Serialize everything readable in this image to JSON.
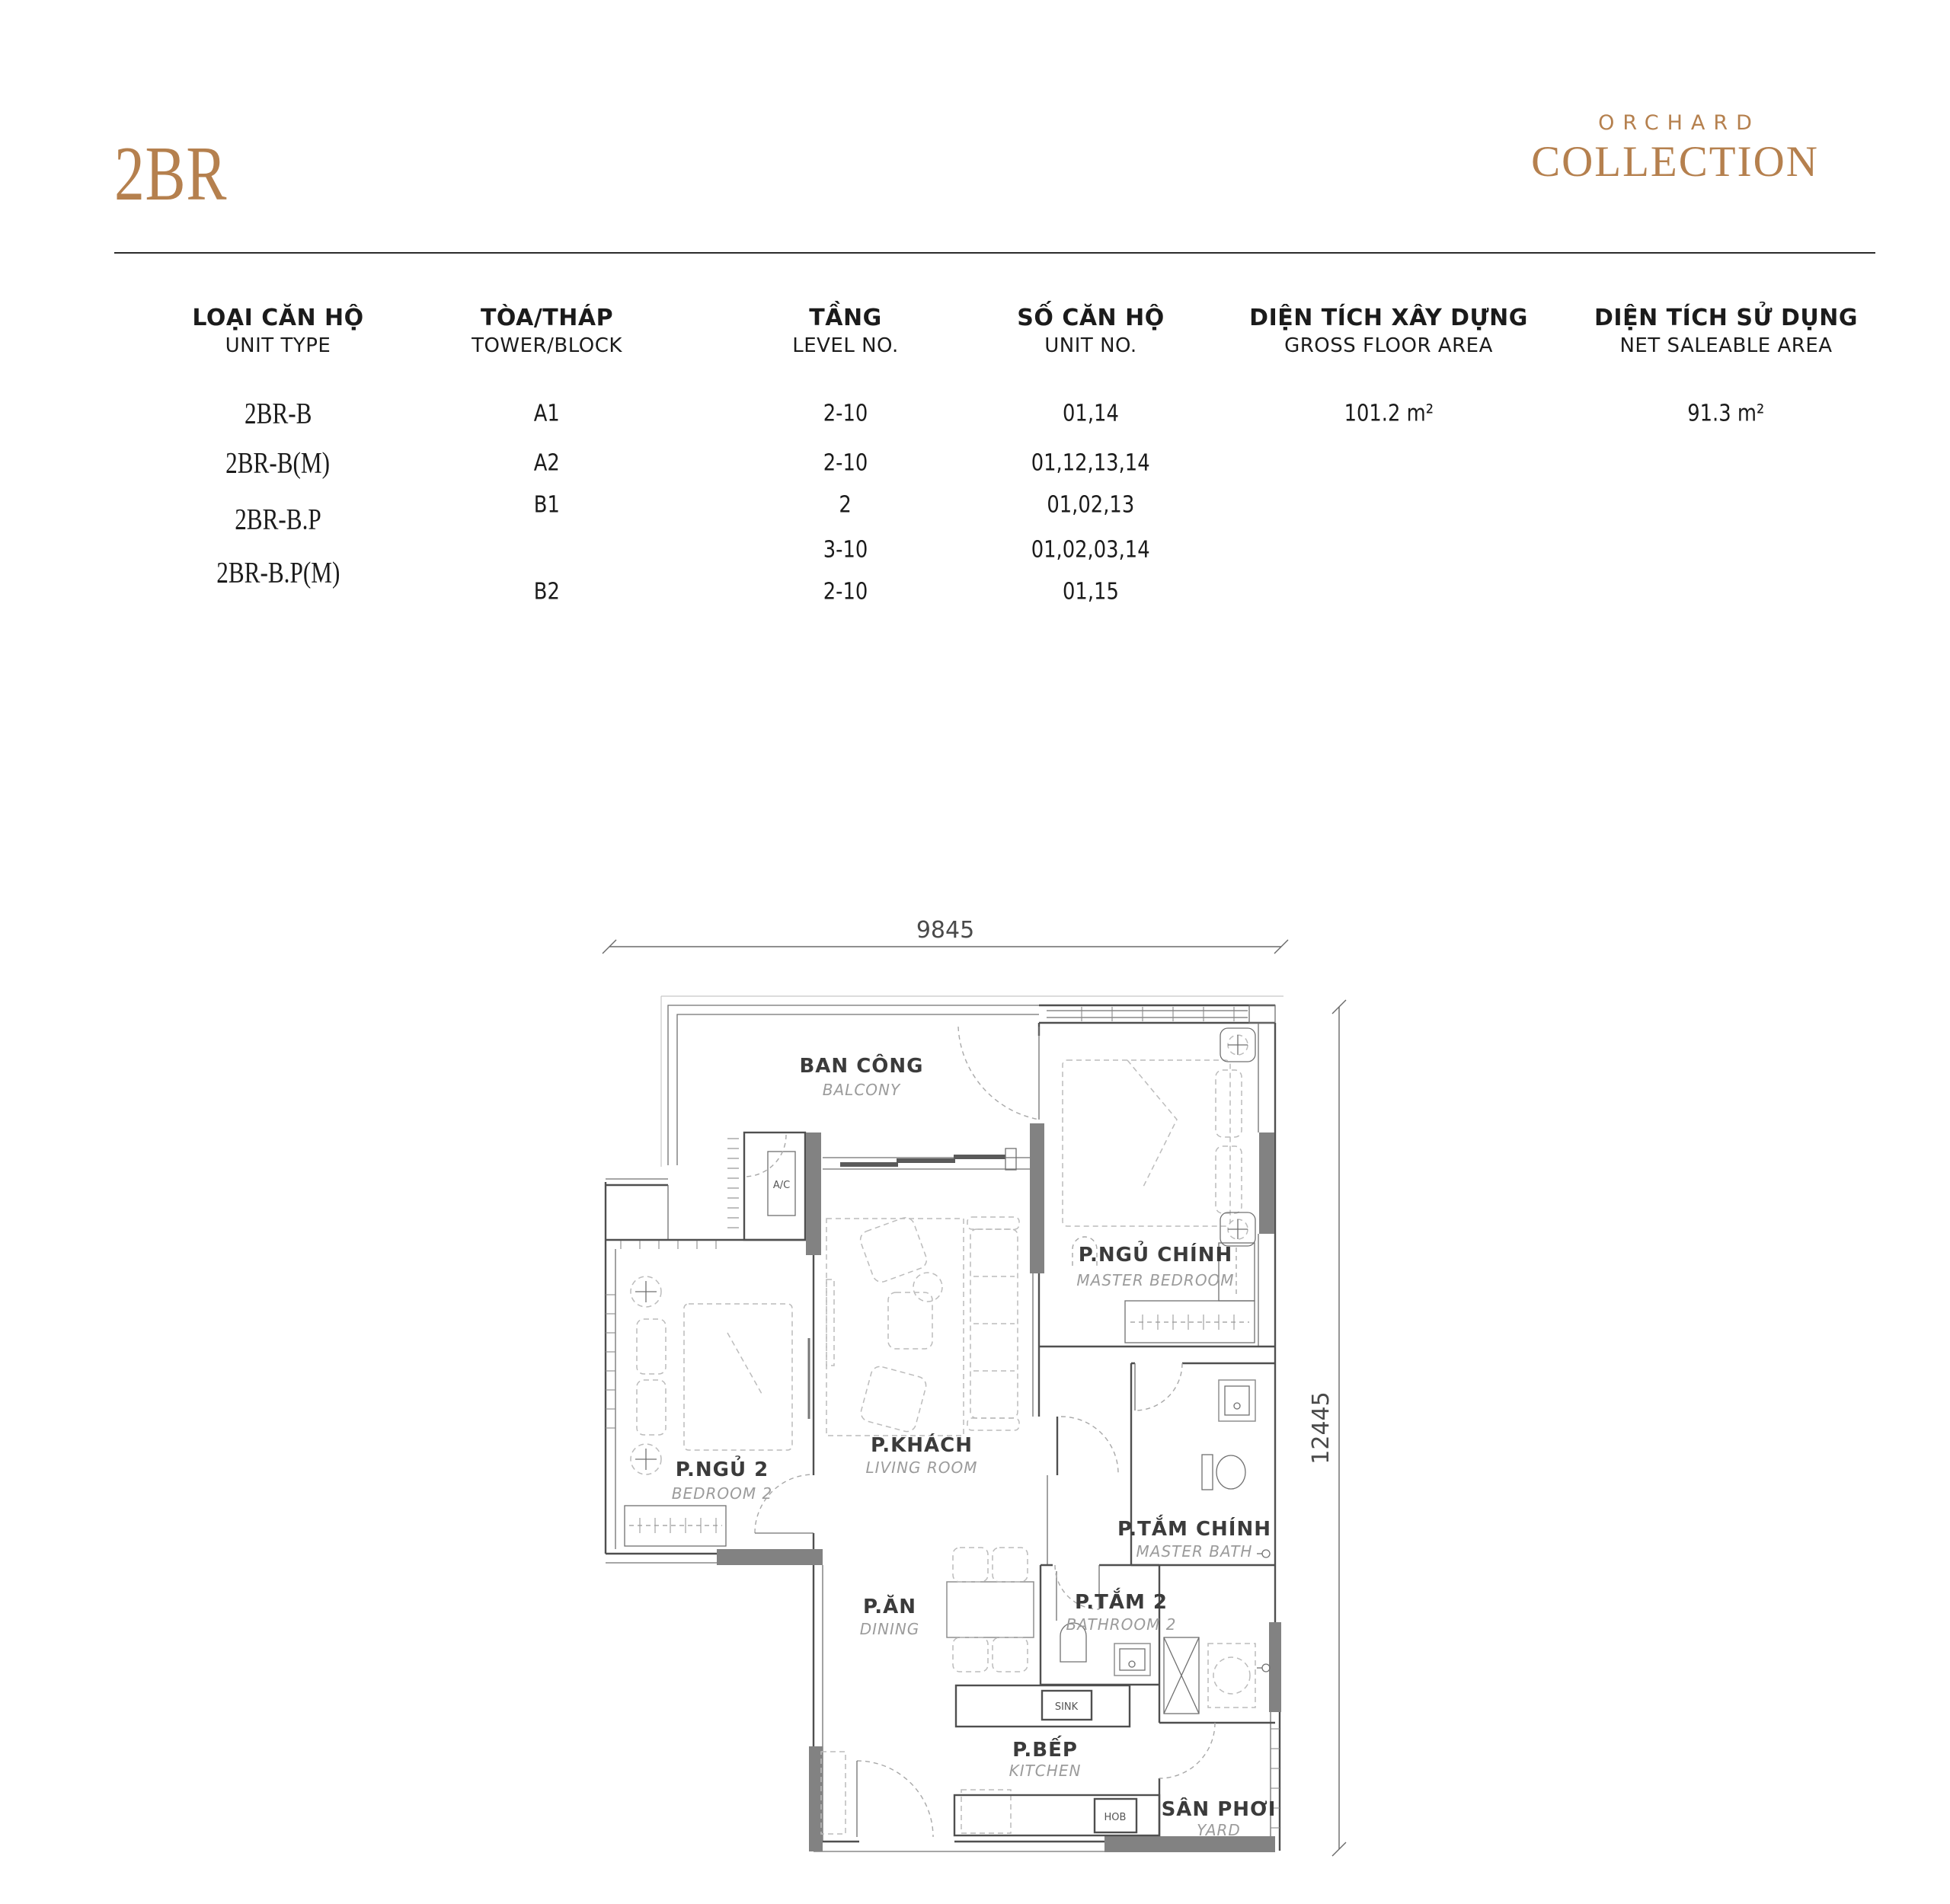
{
  "page": {
    "title": "2BR",
    "brand": {
      "line1": "ORCHARD",
      "line2": "COLLECTION"
    },
    "accent_color": "#b5804e"
  },
  "table": {
    "columns": [
      {
        "vi": "LOẠI CĂN HỘ",
        "en": "UNIT TYPE"
      },
      {
        "vi": "TÒA/THÁP",
        "en": "TOWER/BLOCK"
      },
      {
        "vi": "TẦNG",
        "en": "LEVEL NO."
      },
      {
        "vi": "SỐ CĂN HỘ",
        "en": "UNIT NO."
      },
      {
        "vi": "DIỆN TÍCH XÂY DỰNG",
        "en": "GROSS FLOOR AREA"
      },
      {
        "vi": "DIỆN TÍCH SỬ DỤNG",
        "en": "NET SALEABLE AREA"
      }
    ],
    "unit_types": [
      "2BR-B",
      "2BR-B(M)",
      "2BR-B.P",
      "2BR-B.P(M)"
    ],
    "rows": [
      {
        "tower": "A1",
        "level": "2-10",
        "units": "01,14",
        "gfa": "101.2 m²",
        "nsa": "91.3 m²"
      },
      {
        "tower": "A2",
        "level": "2-10",
        "units": "01,12,13,14"
      },
      {
        "tower": "B1",
        "level": "2",
        "units": "01,02,13"
      },
      {
        "tower": "",
        "level": "3-10",
        "units": "01,02,03,14"
      },
      {
        "tower": "B2",
        "level": "2-10",
        "units": "01,15"
      }
    ]
  },
  "floorplan": {
    "dimensions": {
      "width_label": "9845",
      "height_label": "12445"
    },
    "rooms": [
      {
        "vi": "BAN CÔNG",
        "en": "BALCONY"
      },
      {
        "vi": "P.NGỦ CHÍNH",
        "en": "MASTER BEDROOM"
      },
      {
        "vi": "P.NGỦ 2",
        "en": "BEDROOM 2"
      },
      {
        "vi": "P.KHÁCH",
        "en": "LIVING ROOM"
      },
      {
        "vi": "P.ĂN",
        "en": "DINING"
      },
      {
        "vi": "P.TẮM CHÍNH",
        "en": "MASTER BATH"
      },
      {
        "vi": "P.TẮM 2",
        "en": "BATHROOM 2"
      },
      {
        "vi": "P.BẾP",
        "en": "KITCHEN"
      },
      {
        "vi": "SÂN PHƠI",
        "en": "YARD"
      }
    ],
    "labels": {
      "ac": "A/C",
      "sink": "SINK",
      "hob": "HOB"
    }
  }
}
